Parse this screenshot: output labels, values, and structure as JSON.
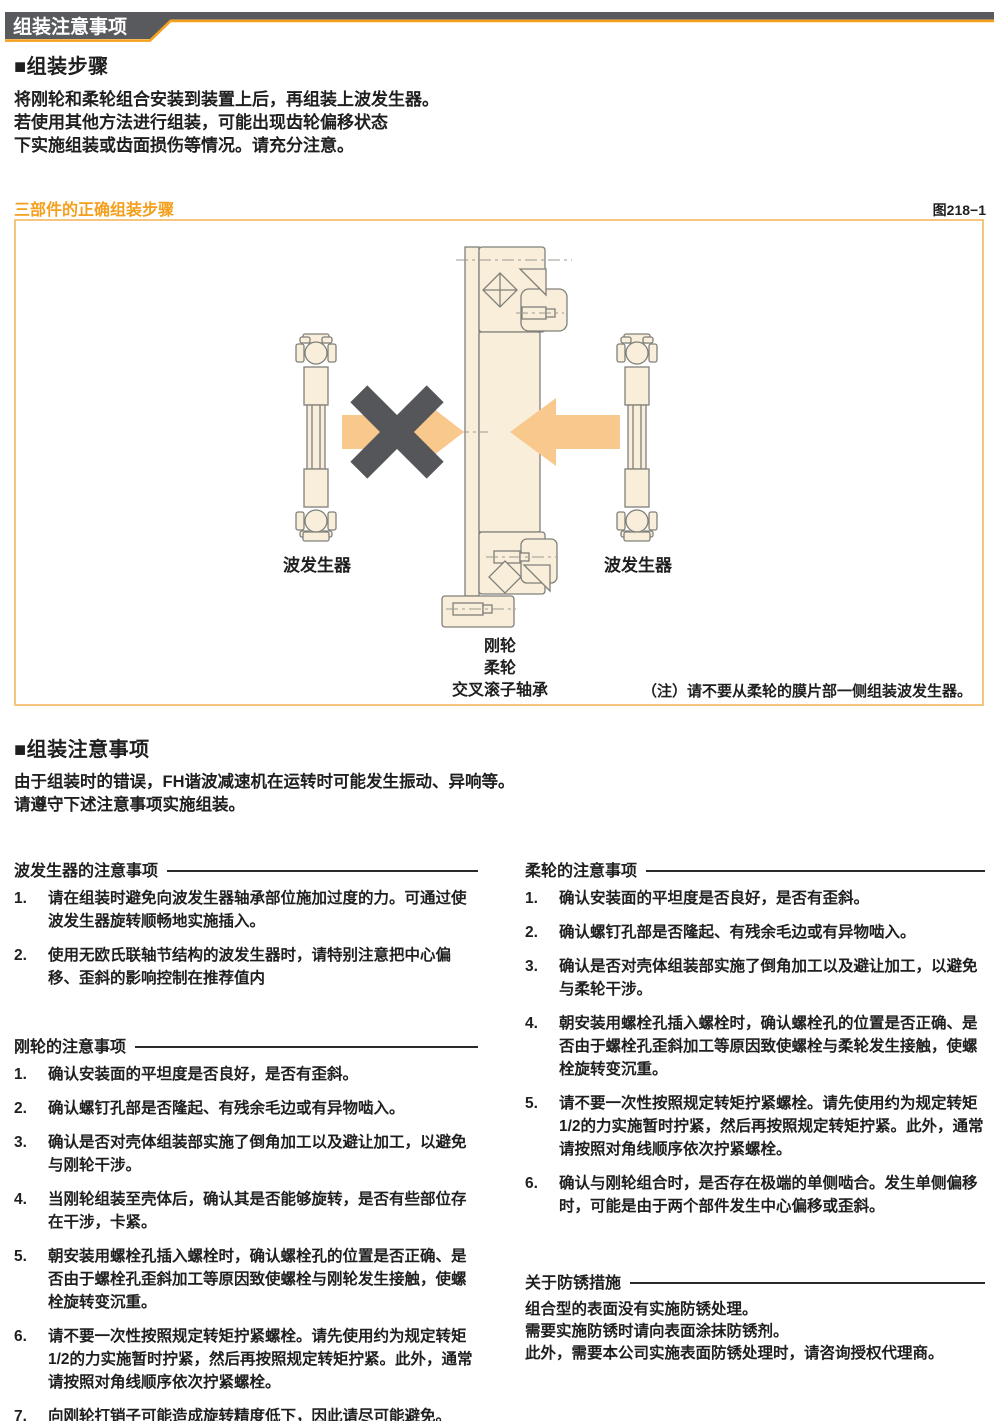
{
  "header": {
    "tab_label": "组装注意事项"
  },
  "assembly_steps": {
    "title": "■组装步骤",
    "lines": [
      "将刚轮和柔轮组合安装到装置上后，再组装上波发生器。",
      "若使用其他方法进行组装，可能出现齿轮偏移状态",
      "下实施组装或齿面损伤等情况。请充分注意。"
    ]
  },
  "figure": {
    "caption": "三部件的正确组装步骤",
    "number": "图218−1",
    "label_left_wave_generator": "波发生器",
    "label_right_wave_generator": "波发生器",
    "part_labels": [
      "刚轮",
      "柔轮",
      "交叉滚子轴承"
    ],
    "note": "（注）请不要从柔轮的膜片部一侧组装波发生器。"
  },
  "assembly_precautions": {
    "title": "■组装注意事项",
    "lines": [
      "由于组装时的错误，FH谐波减速机在运转时可能发生振动、异响等。",
      "请遵守下述注意事项实施组装。"
    ]
  },
  "left_column": {
    "wave_generator": {
      "title": "波发生器的注意事项",
      "items": [
        {
          "no": "1.",
          "text": "请在组装时避免向波发生器轴承部位施加过度的力。可通过使波发生器旋转顺畅地实施插入。"
        },
        {
          "no": "2.",
          "text": "使用无欧氏联轴节结构的波发生器时，请特别注意把中心偏移、歪斜的影响控制在推荐值内"
        }
      ]
    },
    "circular_spline": {
      "title": "刚轮的注意事项",
      "items": [
        {
          "no": "1.",
          "text": "确认安装面的平坦度是否良好，是否有歪斜。"
        },
        {
          "no": "2.",
          "text": "确认螺钉孔部是否隆起、有残余毛边或有异物啮入。"
        },
        {
          "no": "3.",
          "text": "确认是否对壳体组装部实施了倒角加工以及避让加工，以避免与刚轮干涉。"
        },
        {
          "no": "4.",
          "text": "当刚轮组装至壳体后，确认其是否能够旋转，是否有些部位存在干涉，卡紧。"
        },
        {
          "no": "5.",
          "text": "朝安装用螺栓孔插入螺栓时，确认螺栓孔的位置是否正确、是否由于螺栓孔歪斜加工等原因致使螺栓与刚轮发生接触，使螺栓旋转变沉重。"
        },
        {
          "no": "6.",
          "text": "请不要一次性按照规定转矩拧紧螺栓。请先使用约为规定转矩1/2的力实施暂时拧紧，然后再按照规定转矩拧紧。此外，通常请按照对角线顺序依次拧紧螺栓。"
        },
        {
          "no": "7.",
          "text": "向刚轮打销子可能造成旋转精度低下，因此请尽可能避免。"
        }
      ]
    }
  },
  "right_column": {
    "flexspline": {
      "title": "柔轮的注意事项",
      "items": [
        {
          "no": "1.",
          "text": "确认安装面的平坦度是否良好，是否有歪斜。"
        },
        {
          "no": "2.",
          "text": "确认螺钉孔部是否隆起、有残余毛边或有异物啮入。"
        },
        {
          "no": "3.",
          "text": "确认是否对壳体组装部实施了倒角加工以及避让加工，以避免与柔轮干涉。"
        },
        {
          "no": "4.",
          "text": "朝安装用螺栓孔插入螺栓时，确认螺栓孔的位置是否正确、是否由于螺栓孔歪斜加工等原因致使螺栓与柔轮发生接触，使螺栓旋转变沉重。"
        },
        {
          "no": "5.",
          "text": "请不要一次性按照规定转矩拧紧螺栓。请先使用约为规定转矩1/2的力实施暂时拧紧，然后再按照规定转矩拧紧。此外，通常请按照对角线顺序依次拧紧螺栓。"
        },
        {
          "no": "6.",
          "text": "确认与刚轮组合时，是否存在极端的单侧啮合。发生单侧偏移时，可能是由于两个部件发生中心偏移或歪斜。"
        }
      ]
    },
    "rust_prevention": {
      "title": "关于防锈措施",
      "lines": [
        "组合型的表面没有实施防锈处理。",
        "需要实施防锈时请向表面涂抹防锈剂。",
        "此外，需要本公司实施表面防锈处理时，请咨询授权代理商。"
      ]
    }
  },
  "colors": {
    "accent_orange": "#F5A01E",
    "figure_border": "#F6C57F",
    "diagram_fill": "#F9EEDA",
    "arrow_orange": "#F9C88C",
    "x_mark_gray": "#54565A",
    "header_tab_gray": "#595A5E",
    "text": "#1F1F1F"
  }
}
